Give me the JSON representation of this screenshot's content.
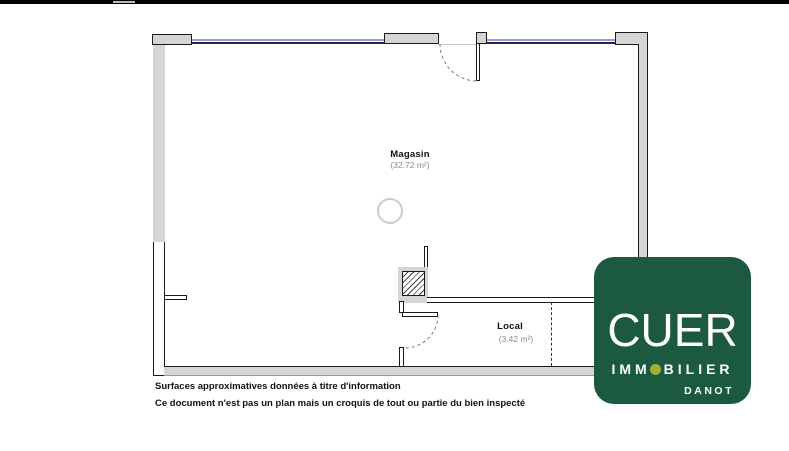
{
  "topbar": {
    "color": "#000000"
  },
  "plan": {
    "rooms": [
      {
        "name": "Magasin",
        "area": "(32.72 m²)"
      },
      {
        "name": "Local",
        "area": "(3.42 m²)"
      }
    ],
    "colors": {
      "wall_fill": "#d3d5d7",
      "outline": "#1a1a1a",
      "window_dark": "#23235c",
      "window_light": "#9aa0c8",
      "door_arc": "#777777",
      "circle_stroke": "#cccccc"
    }
  },
  "footer": {
    "line1": "Surfaces approximatives données à titre d'information",
    "line2": "Ce document n'est pas un plan mais un croquis de tout ou partie du bien inspecté"
  },
  "logo": {
    "brand": "CUER",
    "immo_prefix": "IMM",
    "immo_suffix": "BILIER",
    "subname": "DANOT",
    "bg_color": "#1b5940",
    "dot_color": "#a4af32"
  }
}
